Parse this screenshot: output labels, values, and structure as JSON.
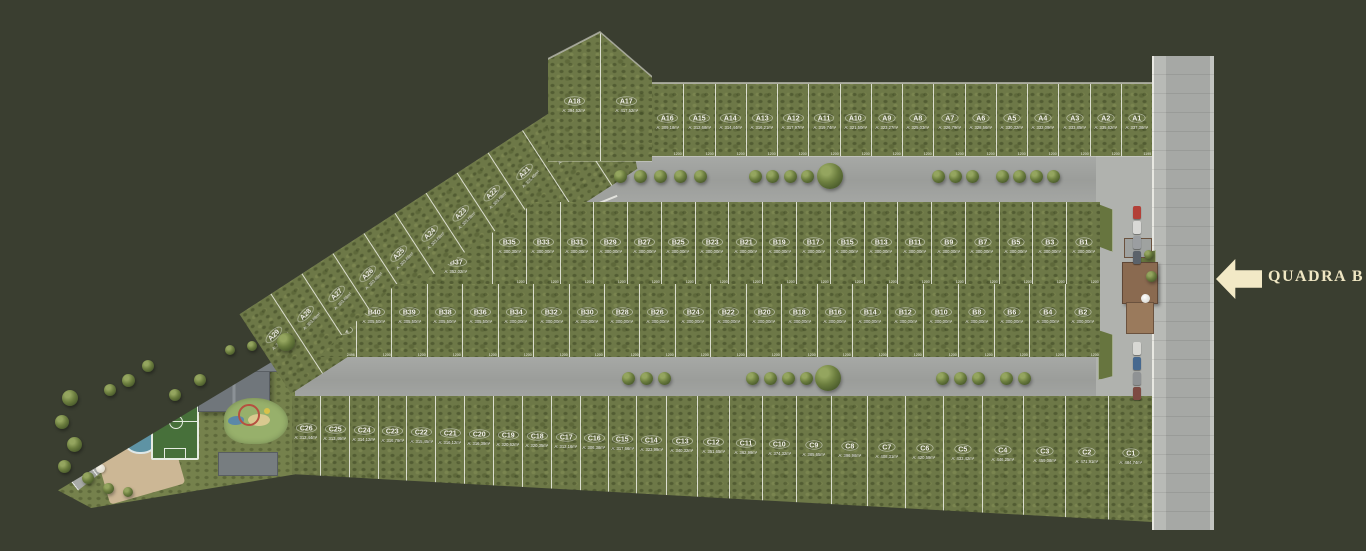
{
  "scene": {
    "quadra_label": "QUADRA B",
    "colors": {
      "background": "#3a3e30",
      "lot_green": "#6d7847",
      "road_gray": "#a2a4a1",
      "accent_cream": "#f2e9c6"
    }
  },
  "bands": {
    "a_diagonal": {
      "name": "Quadra A diagonal row",
      "lots": [
        {
          "id": "A29",
          "area": "A: 305,39m²"
        },
        {
          "id": "A28",
          "area": "A: 303,68m²"
        },
        {
          "id": "A27",
          "area": "A: 303,68m²"
        },
        {
          "id": "A26",
          "area": "A: 303,68m²"
        },
        {
          "id": "A25",
          "area": "A: 303,68m²"
        },
        {
          "id": "A24",
          "area": "A: 303,68m²"
        },
        {
          "id": "A23",
          "area": "A: 303,68m²"
        },
        {
          "id": "A22",
          "area": "A: 303,68m²"
        },
        {
          "id": "A21",
          "area": "A: 325,46m²"
        },
        {
          "id": "A20",
          "area": "A: 361,84m²"
        },
        {
          "id": "A19",
          "area": "A: 386,32m²"
        }
      ]
    },
    "a_bend": {
      "name": "Quadra A corner lots",
      "lots": [
        {
          "id": "A18",
          "area": "A: 394,52m²"
        },
        {
          "id": "A17",
          "area": "A: 417,52m²"
        }
      ]
    },
    "a_top": {
      "name": "Quadra A top row",
      "frontage_label": "1200",
      "lots": [
        {
          "id": "A16",
          "area": "A: 309,18m²"
        },
        {
          "id": "A15",
          "area": "A: 312,68m²"
        },
        {
          "id": "A14",
          "area": "A: 314,44m²"
        },
        {
          "id": "A13",
          "area": "A: 316,21m²"
        },
        {
          "id": "A12",
          "area": "A: 317,97m²"
        },
        {
          "id": "A11",
          "area": "A: 319,74m²"
        },
        {
          "id": "A10",
          "area": "A: 321,50m²"
        },
        {
          "id": "A9",
          "area": "A: 323,27m²"
        },
        {
          "id": "A8",
          "area": "A: 325,03m²"
        },
        {
          "id": "A7",
          "area": "A: 326,79m²"
        },
        {
          "id": "A6",
          "area": "A: 328,56m²"
        },
        {
          "id": "A5",
          "area": "A: 330,32m²"
        },
        {
          "id": "A4",
          "area": "A: 332,09m²"
        },
        {
          "id": "A3",
          "area": "A: 333,85m²"
        },
        {
          "id": "A2",
          "area": "A: 335,62m²"
        },
        {
          "id": "A1",
          "area": "A: 337,38m²",
          "frontage": "1195"
        }
      ]
    },
    "b_upper": {
      "name": "Quadra B upper row",
      "frontage_label": "1200",
      "depth_label": "2500",
      "lots": [
        {
          "id": "B37",
          "area": "A: 352,02m²",
          "frontage": ""
        },
        {
          "id": "B35",
          "area": "A: 300,30m²"
        },
        {
          "id": "B33",
          "area": "A: 300,00m²"
        },
        {
          "id": "B31",
          "area": "A: 300,00m²"
        },
        {
          "id": "B29",
          "area": "A: 300,00m²"
        },
        {
          "id": "B27",
          "area": "A: 300,00m²"
        },
        {
          "id": "B25",
          "area": "A: 300,00m²"
        },
        {
          "id": "B23",
          "area": "A: 300,00m²"
        },
        {
          "id": "B21",
          "area": "A: 300,00m²"
        },
        {
          "id": "B19",
          "area": "A: 300,00m²"
        },
        {
          "id": "B17",
          "area": "A: 300,00m²"
        },
        {
          "id": "B15",
          "area": "A: 300,00m²"
        },
        {
          "id": "B13",
          "area": "A: 300,00m²"
        },
        {
          "id": "B11",
          "area": "A: 300,00m²"
        },
        {
          "id": "B9",
          "area": "A: 300,00m²"
        },
        {
          "id": "B7",
          "area": "A: 300,00m²"
        },
        {
          "id": "B5",
          "area": "A: 300,00m²"
        },
        {
          "id": "B3",
          "area": "A: 300,00m²"
        },
        {
          "id": "B1",
          "area": "A: 300,00m²"
        }
      ]
    },
    "b_lower": {
      "name": "Quadra B lower row",
      "frontage_label": "1200",
      "depth_label": "2500",
      "lots": [
        {
          "id": "B41",
          "frontage": "2496"
        },
        {
          "id": "B40",
          "area": "A: 305,50m²"
        },
        {
          "id": "B39",
          "area": "A: 305,50m²"
        },
        {
          "id": "B38",
          "area": "A: 305,50m²"
        },
        {
          "id": "B36",
          "area": "A: 305,50m²"
        },
        {
          "id": "B34",
          "area": "A: 300,00m²"
        },
        {
          "id": "B32",
          "area": "A: 300,00m²"
        },
        {
          "id": "B30",
          "area": "A: 300,00m²"
        },
        {
          "id": "B28",
          "area": "A: 300,00m²"
        },
        {
          "id": "B26",
          "area": "A: 300,00m²"
        },
        {
          "id": "B24",
          "area": "A: 300,00m²"
        },
        {
          "id": "B22",
          "area": "A: 300,00m²"
        },
        {
          "id": "B20",
          "area": "A: 300,00m²"
        },
        {
          "id": "B18",
          "area": "A: 300,00m²"
        },
        {
          "id": "B16",
          "area": "A: 300,00m²"
        },
        {
          "id": "B14",
          "area": "A: 300,00m²"
        },
        {
          "id": "B12",
          "area": "A: 300,00m²"
        },
        {
          "id": "B10",
          "area": "A: 300,00m²"
        },
        {
          "id": "B8",
          "area": "A: 300,00m²"
        },
        {
          "id": "B6",
          "area": "A: 300,00m²"
        },
        {
          "id": "B4",
          "area": "A: 300,00m²"
        },
        {
          "id": "B2",
          "area": "A: 300,00m²"
        }
      ]
    },
    "c_row": {
      "name": "Quadra C row",
      "lots": [
        {
          "id": "C26",
          "area": "A: 312,44m²"
        },
        {
          "id": "C25",
          "area": "A: 313,46m²"
        },
        {
          "id": "C24",
          "area": "A: 314,12m²"
        },
        {
          "id": "C23",
          "area": "A: 316,79m²"
        },
        {
          "id": "C22",
          "area": "A: 315,45m²"
        },
        {
          "id": "C21",
          "area": "A: 316,12m²"
        },
        {
          "id": "C20",
          "area": "A: 316,39m²"
        },
        {
          "id": "C19",
          "area": "A: 320,62m²"
        },
        {
          "id": "C18",
          "area": "A: 320,35m²"
        },
        {
          "id": "C17",
          "area": "A: 312,16m²"
        },
        {
          "id": "C16",
          "area": "A: 306,38m²"
        },
        {
          "id": "C15",
          "area": "A: 317,66m²"
        },
        {
          "id": "C14",
          "area": "A: 323,99m²"
        },
        {
          "id": "C13",
          "area": "A: 340,32m²"
        },
        {
          "id": "C12",
          "area": "A: 351,65m²"
        },
        {
          "id": "C11",
          "area": "A: 362,99m²"
        },
        {
          "id": "C10",
          "area": "A: 374,32m²"
        },
        {
          "id": "C9",
          "area": "A: 385,65m²"
        },
        {
          "id": "C8",
          "area": "A: 396,98m²"
        },
        {
          "id": "C7",
          "area": "A: 408,31m²"
        },
        {
          "id": "C6",
          "area": "A: 420,59m²"
        },
        {
          "id": "C5",
          "area": "A: 433,42m²"
        },
        {
          "id": "C4",
          "area": "A: 446,25m²"
        },
        {
          "id": "C3",
          "area": "A: 459,08m²"
        },
        {
          "id": "C2",
          "area": "A: 471,91m²"
        },
        {
          "id": "C1",
          "area": "A: 484,74m²"
        }
      ]
    }
  }
}
